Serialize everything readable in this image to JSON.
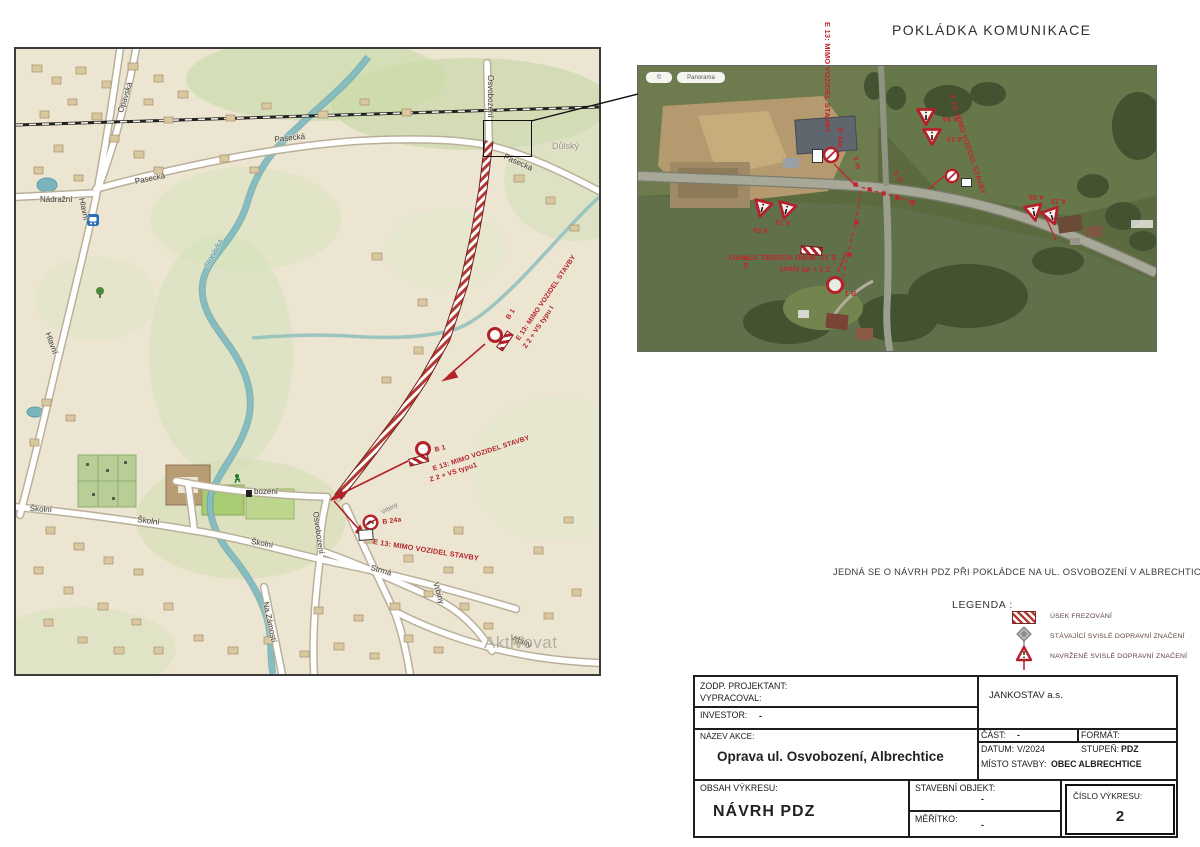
{
  "page": {
    "title": "POKLÁDKA KOMUNIKACE",
    "note": "JEDNÁ SE O NÁVRH PDZ PŘI POKLÁDCE NA UL. OSVOBOZENÍ V ALBRECHTICÍCH"
  },
  "legend": {
    "title": "LEGENDA :",
    "items": [
      {
        "label": "ÚSEK FREZOVÁNÍ"
      },
      {
        "label": "STÁVAJÍCÍ SVISLÉ DOPRAVNÍ ZNAČENÍ"
      },
      {
        "label": "NAVRŽENÉ SVISLÉ DOPRAVNÍ ZNAČENÍ"
      }
    ]
  },
  "map": {
    "watermark": "Aktivovat",
    "street_labels": [
      "Nádražní",
      "Opavská",
      "Pasecká",
      "Pasecká",
      "Pasecká",
      "Hlavní",
      "Hlavní",
      "Stonávka",
      "Školní",
      "Školní",
      "Školní",
      "Osvobození",
      "Osvobození",
      "bození",
      "Strmá",
      "Vrbiny",
      "Vrbiny",
      "Na Zámostí",
      "Důlský"
    ],
    "annotations": {
      "a1_sign": "B 1",
      "a1_l1": "E 13: MIMO VOZIDEL STAVBY",
      "a1_l2": "Z 2 + VS typu I",
      "a2_sign": "B 1",
      "a2_l1": "E 13: MIMO VOZIDEL STAVBY",
      "a2_l2": "Z 2 + VS typu1",
      "a3_sign": "B 24a",
      "a3_l1": "E 13: MIMO VOZIDEL STAVBY",
      "a3_street": "Vrbiny"
    }
  },
  "aerial": {
    "attribution_left": "©",
    "attribution_right": "Panorama",
    "labels": {
      "e13": "E 13: MIMO VOZIDEL STAVBY",
      "b24a": "B 24a",
      "b1": "B 1",
      "m3": "3 m",
      "a6a": "A 6a",
      "a6b": "A 6b",
      "a15": "A 15",
      "z2": "Z 2 + VS typu1"
    }
  },
  "titleblock": {
    "zodp": "ZODP. PROJEKTANT:",
    "vypracoval": "VYPRACOVAL:",
    "investor": "INVESTOR:",
    "investor_value": "-",
    "company": "JANKOSTAV a.s.",
    "nazev_akce": "NÁZEV AKCE:",
    "nazev_value": "Oprava ul. Osvobození, Albrechtice",
    "cast": "ČÁST:",
    "cast_value": "-",
    "format": "FORMÁT:",
    "datum": "DATUM:",
    "datum_value": "V/2024",
    "stupen": "STUPEŇ:",
    "stupen_value": "PDZ",
    "misto": "MÍSTO STAVBY:",
    "misto_value": "OBEC ALBRECHTICE",
    "obsah": "OBSAH VÝKRESU:",
    "obsah_value": "NÁVRH PDZ",
    "stavebni": "STAVEBNÍ OBJEKT:",
    "stavebni_value": "-",
    "meritko": "MĚŘÍTKO:",
    "meritko_value": "-",
    "cislo": "ČÍSLO VÝKRESU:",
    "cislo_value": "2"
  },
  "colors": {
    "annotation_red": "#b5212a",
    "hatch_red": "#b23a34",
    "water": "#7ab5bb",
    "map_background": "#ece5d1"
  }
}
